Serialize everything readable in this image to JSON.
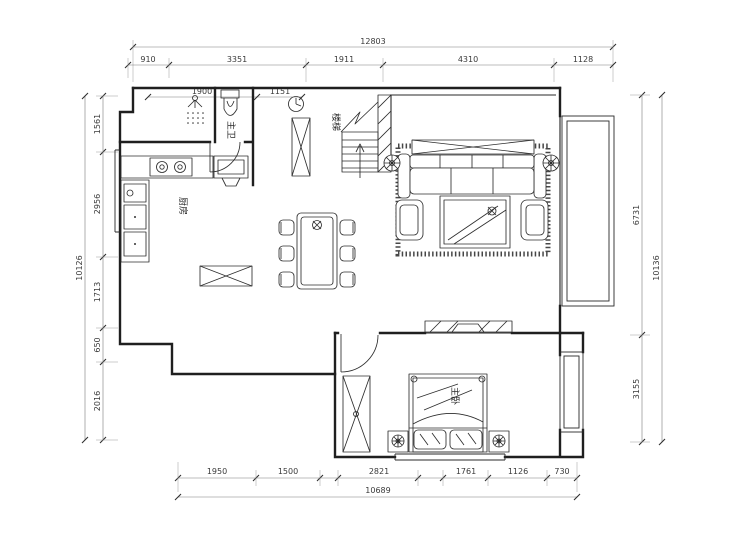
{
  "drawing": {
    "kind": "apartment-floor-plan",
    "bg_color": "#ffffff",
    "line_color": "#1f1f1f",
    "dim_color": "#3a3a3a"
  },
  "dims": {
    "top_total": "12803",
    "top": [
      "910",
      "3351",
      "1911",
      "4310",
      "1128"
    ],
    "top_inner": [
      "1900",
      "1151"
    ],
    "left_total": "10126",
    "left": [
      "1561",
      "2956",
      "1713",
      "650",
      "2016"
    ],
    "right_total": "10136",
    "right": [
      "6731",
      "3155"
    ],
    "bottom_total": "10689",
    "bottom": [
      "1950",
      "1500",
      "2821",
      "1761",
      "1126",
      "730"
    ]
  },
  "rooms": {
    "kitchen": "厨房",
    "bath": "主卫",
    "stairs": "楼梯",
    "bedroom": "主卧"
  }
}
